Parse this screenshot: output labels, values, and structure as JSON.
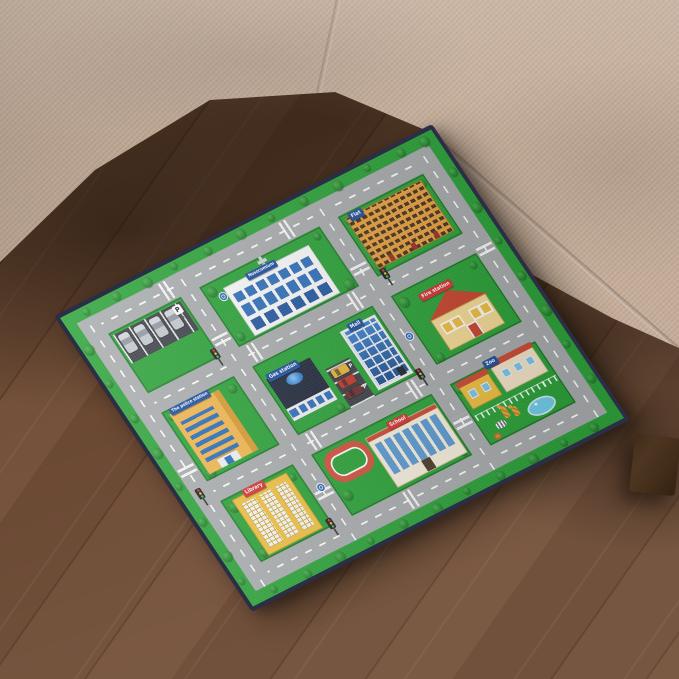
{
  "mat": {
    "signs": {
      "police": "The police station",
      "gas": "Gas station",
      "flat": "Flat",
      "hospital": "Nosocomium",
      "mall": "Mall",
      "fire": "Fire station",
      "school": "School",
      "library": "Library",
      "zoo": "Zoo",
      "parking": "P"
    },
    "colors": {
      "grass": "#2aa237",
      "road": "#a9acae",
      "binding": "#2b2e45",
      "sign_blue": "#1d4f9e",
      "sign_red": "#d63333",
      "track_red": "#d4503c",
      "asphalt": "#3c4046"
    }
  },
  "room": {
    "colors": {
      "sofa_fabric": "#c6ae9a",
      "wood_floor": "#6b4a34",
      "sofa_leg": "#46301d"
    }
  },
  "icons": {
    "tree": "green-circle",
    "traffic_light": "three-dot-box",
    "roundabout_sign": "blue-circle",
    "zebra_crossing": "white-stripe-bars",
    "car": "rounded-rect",
    "hospital_cross": "grey-cross",
    "gas_globe": "blue-ellipse",
    "pond": "blue-ellipse",
    "giraffe": "spotted-shape",
    "zebra": "striped-shape",
    "lion": "round-shape",
    "fence": "white-posts"
  }
}
